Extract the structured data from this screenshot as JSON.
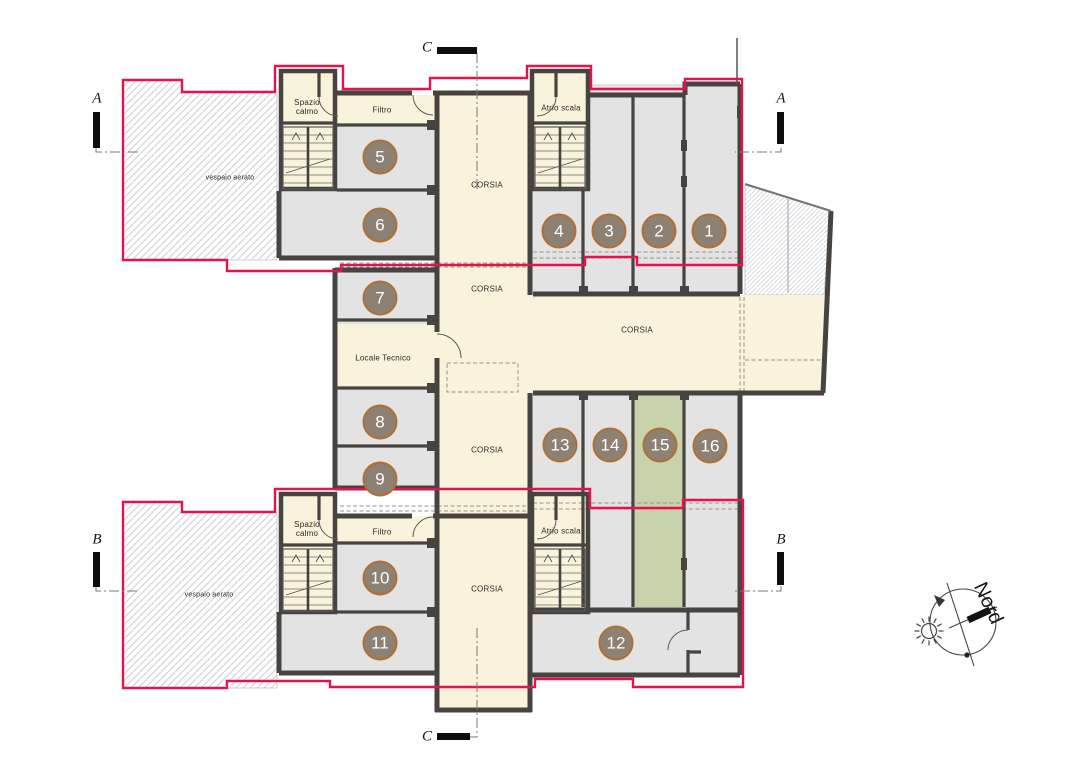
{
  "plan": {
    "room_numbers": [
      "1",
      "2",
      "3",
      "4",
      "5",
      "6",
      "7",
      "8",
      "9",
      "10",
      "11",
      "12",
      "13",
      "14",
      "15",
      "16"
    ],
    "labels": {
      "corsia": "CORSIA",
      "spazio_calmo": "Spazio calmo",
      "filtro": "Filtro",
      "atrio_scala": "Atrio scala",
      "locale_tecnico": "Locale Tecnico",
      "vespaio_aerato": "vespaio aerato"
    },
    "sections": {
      "a": "A",
      "b": "B",
      "c": "C"
    },
    "north_label": "Nord",
    "colors": {
      "outline_red": "#e4134f",
      "room_gray": "#e3e3e4",
      "corridor_cream": "#f8f3da",
      "room_green": "#c9d3ab",
      "wall_dark": "#474340",
      "circle_fill": "#8d8174",
      "circle_border": "#b26f31"
    }
  }
}
